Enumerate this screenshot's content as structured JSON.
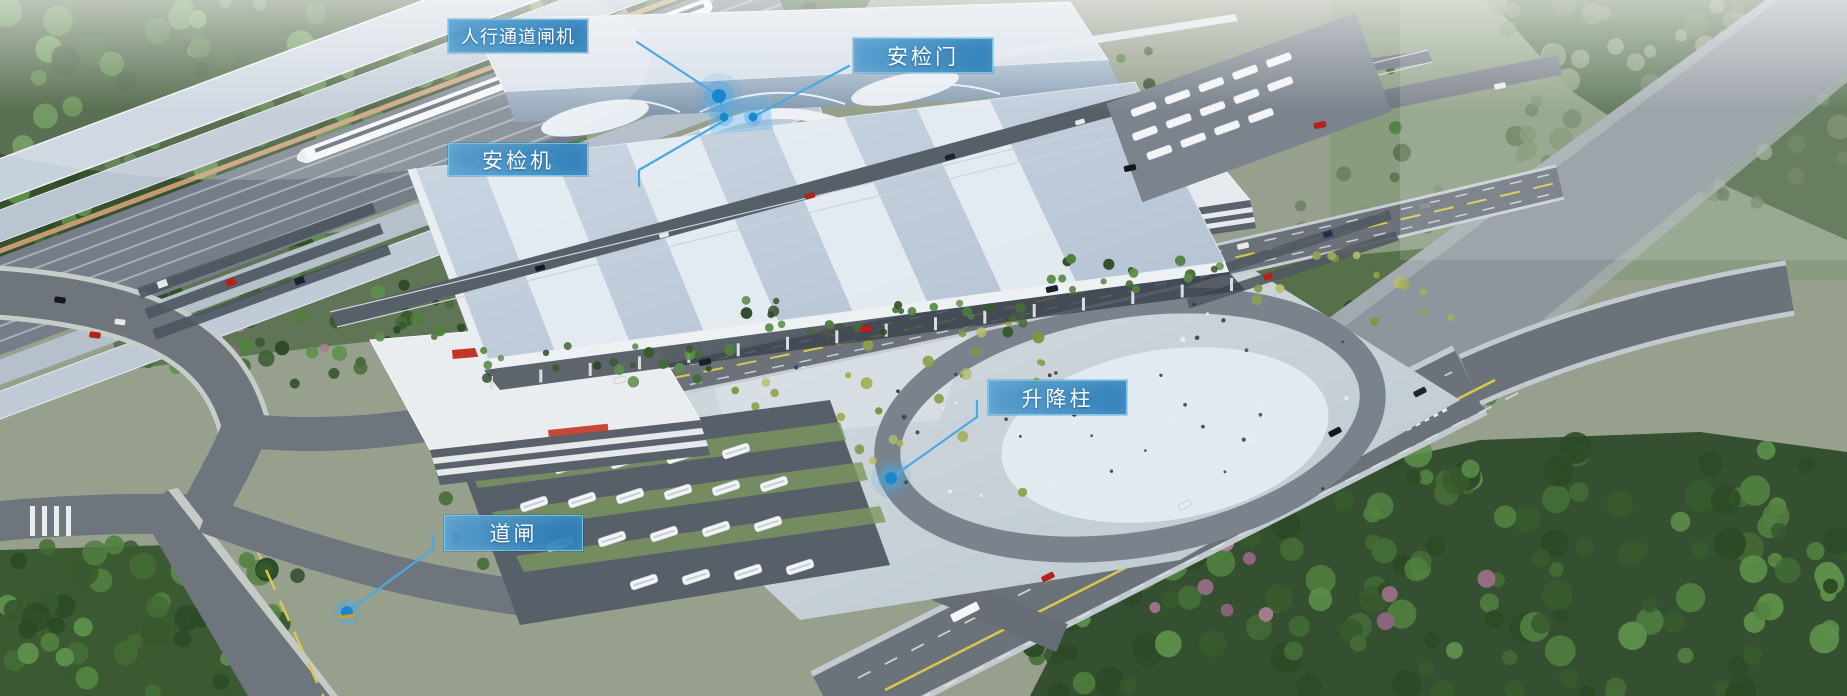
{
  "callouts": [
    {
      "id": "pedestrian-gate",
      "label": "人行通道闸机"
    },
    {
      "id": "security-door",
      "label": "安检门"
    },
    {
      "id": "security-scanner",
      "label": "安检机"
    },
    {
      "id": "lift-bollard",
      "label": "升降柱"
    },
    {
      "id": "barrier-gate",
      "label": "道闸"
    }
  ],
  "colors": {
    "label_background": "#2a86c4",
    "label_border": "#6ec6ef",
    "leader_line": "#49a9e4",
    "dot_fill": "#1887d2",
    "station_sign_red": "#c23527",
    "road_marking_yellow": "#d8c94a"
  }
}
